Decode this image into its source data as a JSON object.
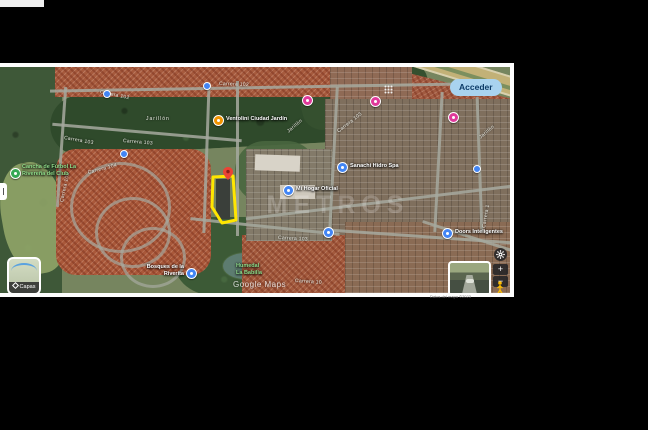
{
  "header": {
    "signin": "Acceder"
  },
  "controls": {
    "layers": "Capas",
    "zoom_in": "+",
    "zoom_out": "−"
  },
  "watermarks": {
    "site": "METROS",
    "google": "Google Maps",
    "attribution": "Datos del mapa ©2023"
  },
  "pois": {
    "soccer": {
      "line1": "Cancha de Fútbol La",
      "line2": "Rivereña del Club"
    },
    "ventolini": {
      "label": "Ventolini Ciudad Jardín"
    },
    "sanachi": {
      "label": "Sanachi Hidro Spa"
    },
    "mihogar": {
      "label": "Mi Hogar Oficial"
    },
    "doors": {
      "label": "Doors Inteligentes"
    },
    "conjunto": {
      "line1": "Bosques de la",
      "line2": "Riverita"
    },
    "humedal": {
      "line1": "Humedal",
      "line2": "La Babilla"
    }
  },
  "streets": {
    "carrera102a": "Carrera 102",
    "carrera102b": "Carrera 102",
    "carrera103a": "Carrera 103",
    "carrera103b": "Carrera 103",
    "carrera103c": "Carrera 103",
    "carrera103d": "Carrera 103",
    "carrera104": "Carrera 104",
    "carrera105": "Carrera 105",
    "jarillon_a": "Jarillón",
    "jarillon_b": "Jarillón",
    "jarillon_c": "Jarillón",
    "carrera10": "Carrera 10",
    "carrera1": "Carrera 1"
  },
  "colors": {
    "polygon_yellow": "#ffe600",
    "pin_red": "#ea4335",
    "poi_blue": "#4285f4",
    "poi_pink": "#e0399b",
    "poi_orange": "#f09300",
    "poi_green": "#34a853",
    "signin_bg": "#a9d3ef",
    "signin_text": "#0b3a66"
  }
}
